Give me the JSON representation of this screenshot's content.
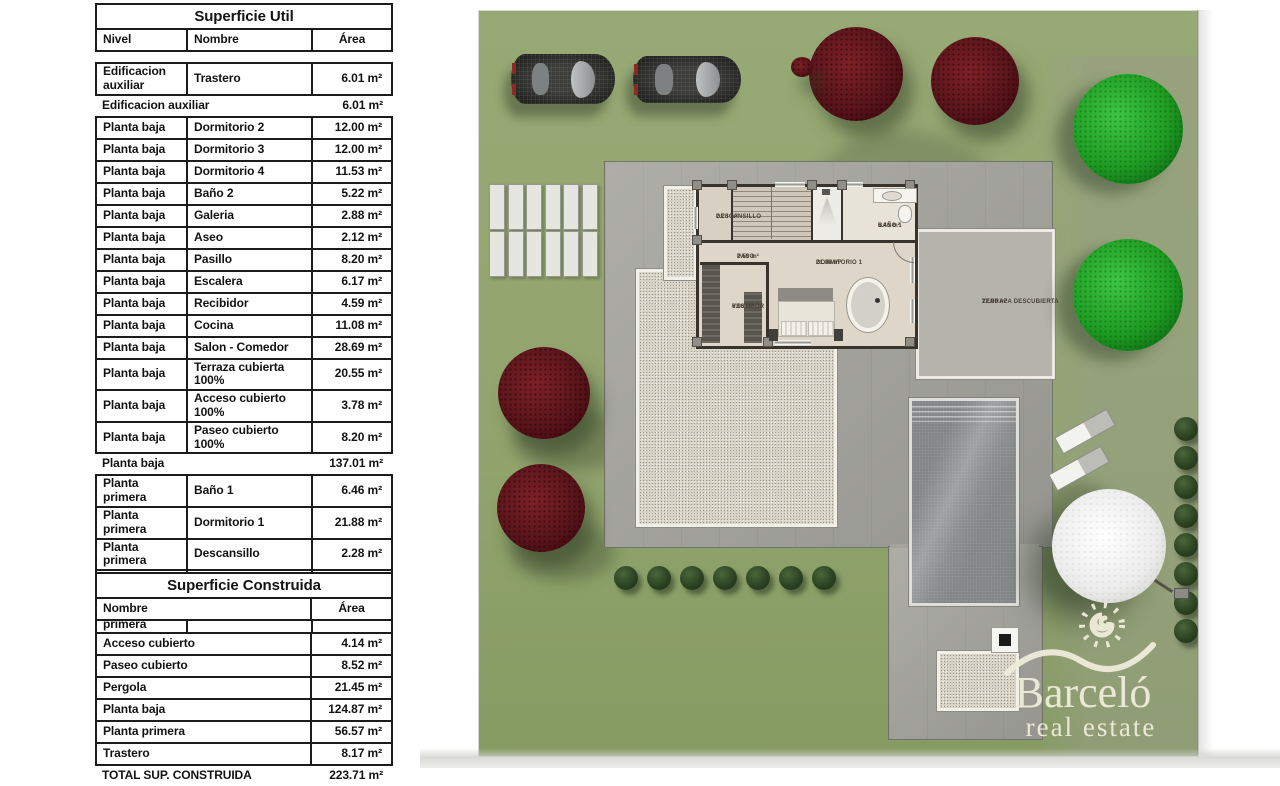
{
  "superficie_util": {
    "title": "Superficie Util",
    "col_nivel": "Nivel",
    "col_nombre": "Nombre",
    "col_area": "Área",
    "rows": [
      {
        "type": "detail",
        "nivel": "Edificacion auxiliar",
        "nombre": "Trastero",
        "area": "6.01 m²"
      },
      {
        "type": "subtotal",
        "label": "Edificacion auxiliar",
        "area": "6.01 m²"
      },
      {
        "type": "detail",
        "nivel": "Planta baja",
        "nombre": "Dormitorio 2",
        "area": "12.00 m²"
      },
      {
        "type": "detail",
        "nivel": "Planta baja",
        "nombre": "Dormitorio 3",
        "area": "12.00 m²"
      },
      {
        "type": "detail",
        "nivel": "Planta baja",
        "nombre": "Dormitorio 4",
        "area": "11.53 m²"
      },
      {
        "type": "detail",
        "nivel": "Planta baja",
        "nombre": "Baño 2",
        "area": "5.22 m²"
      },
      {
        "type": "detail",
        "nivel": "Planta baja",
        "nombre": "Galeria",
        "area": "2.88 m²"
      },
      {
        "type": "detail",
        "nivel": "Planta baja",
        "nombre": "Aseo",
        "area": "2.12 m²"
      },
      {
        "type": "detail",
        "nivel": "Planta baja",
        "nombre": "Pasillo",
        "area": "8.20 m²"
      },
      {
        "type": "detail",
        "nivel": "Planta baja",
        "nombre": "Escalera",
        "area": "6.17 m²"
      },
      {
        "type": "detail",
        "nivel": "Planta baja",
        "nombre": "Recibidor",
        "area": "4.59 m²"
      },
      {
        "type": "detail",
        "nivel": "Planta baja",
        "nombre": "Cocina",
        "area": "11.08 m²"
      },
      {
        "type": "detail",
        "nivel": "Planta baja",
        "nombre": "Salon - Comedor",
        "area": "28.69 m²"
      },
      {
        "type": "detail",
        "nivel": "Planta baja",
        "nombre": "Terraza cubierta 100%",
        "area": "20.55 m²"
      },
      {
        "type": "detail",
        "nivel": "Planta baja",
        "nombre": "Acceso cubierto 100%",
        "area": "3.78 m²"
      },
      {
        "type": "detail",
        "nivel": "Planta baja",
        "nombre": "Paseo cubierto 100%",
        "area": "8.20 m²"
      },
      {
        "type": "subtotal",
        "label": "Planta baja",
        "area": "137.01 m²"
      },
      {
        "type": "detail",
        "nivel": "Planta primera",
        "nombre": "Baño 1",
        "area": "6.46 m²"
      },
      {
        "type": "detail",
        "nivel": "Planta primera",
        "nombre": "Dormitorio 1",
        "area": "21.88 m²"
      },
      {
        "type": "detail",
        "nivel": "Planta primera",
        "nombre": "Descansillo",
        "area": "2.28 m²"
      },
      {
        "type": "detail",
        "nivel": "Planta primera",
        "nombre": "Paso",
        "area": "2.50 m²"
      },
      {
        "type": "detail",
        "nivel": "Planta primera",
        "nombre": "Vestidor",
        "area": "6.96 m²"
      },
      {
        "type": "subtotal",
        "label": "Planta primera",
        "area": "40.08 m²"
      },
      {
        "type": "total",
        "label": "TOTAL SUP. UTIL",
        "area": "183.10 m²"
      }
    ]
  },
  "superficie_construida": {
    "title": "Superficie Construida",
    "col_nombre": "Nombre",
    "col_area": "Área",
    "rows": [
      {
        "type": "detail",
        "nombre": "Acceso cubierto",
        "area": "4.14 m²"
      },
      {
        "type": "detail",
        "nombre": "Paseo cubierto",
        "area": "8.52 m²"
      },
      {
        "type": "detail",
        "nombre": "Pergola",
        "area": "21.45 m²"
      },
      {
        "type": "detail",
        "nombre": "Planta baja",
        "area": "124.87 m²"
      },
      {
        "type": "detail",
        "nombre": "Planta primera",
        "area": "56.57 m²"
      },
      {
        "type": "detail",
        "nombre": "Trastero",
        "area": "8.17 m²"
      },
      {
        "type": "total",
        "label": "TOTAL SUP. CONSTRUIDA",
        "area": "223.71 m²"
      }
    ]
  },
  "plan": {
    "rooms": {
      "descansillo": {
        "name": "DESCANSILLO",
        "area": "2.28 m²"
      },
      "paso": {
        "name": "PASO",
        "area": "2.50 m²"
      },
      "bano1": {
        "name": "BAÑO 1",
        "area": "6.46 m²"
      },
      "dormitorio1": {
        "name": "DORMITORIO 1",
        "area": "21.88 m²"
      },
      "vestidor": {
        "name": "VESTIDOR",
        "area": "6.96 m²"
      },
      "terraza": {
        "name": "TERRAZA DESCUBIERTA",
        "area": "22.00 m²"
      }
    },
    "watermark": {
      "brand": "Barceló",
      "tagline": "real estate"
    }
  },
  "colors": {
    "lawn": "#92a56e",
    "paving": "#a7a7a0",
    "gravel": "#d7d3c6",
    "pool_water": "#85878a",
    "tree_red": "#5a151b",
    "tree_green": "#1e9c22",
    "bush": "#2a4020",
    "watermark": "#eeedda"
  }
}
